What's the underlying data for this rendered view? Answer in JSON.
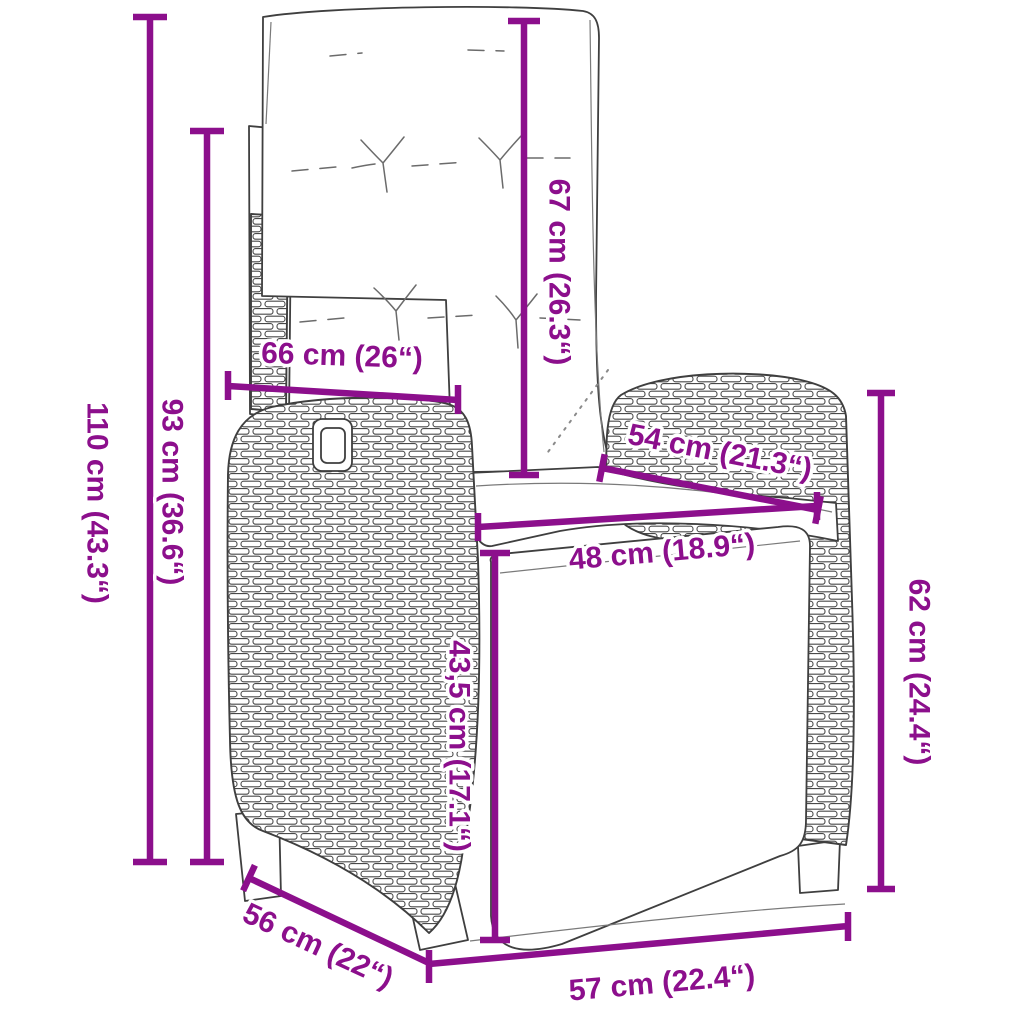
{
  "style": {
    "dimension_color": "#8C0F8C",
    "line_art_color": "#3f3f3f",
    "background": "#ffffff"
  },
  "dimensions": {
    "overall_height": {
      "label": "110 cm (43.3“)",
      "cm": "110",
      "inches": "43.3"
    },
    "backrest_height": {
      "label": "93 cm (36.6“)",
      "cm": "93",
      "inches": "36.6"
    },
    "armrest_top_width": {
      "label": "66 cm (26“)",
      "cm": "66",
      "inches": "26"
    },
    "back_cushion_height": {
      "label": "67 cm (26.3“)",
      "cm": "67",
      "inches": "26.3"
    },
    "armrest_depth": {
      "label": "54 cm (21.3“)",
      "cm": "54",
      "inches": "21.3"
    },
    "seat_width": {
      "label": "48 cm (18.9“)",
      "cm": "48",
      "inches": "18.9"
    },
    "footrest_height": {
      "label": "43,5 cm (17.1“)",
      "cm": "43,5",
      "inches": "17.1"
    },
    "armrest_height": {
      "label": "62 cm (24.4“)",
      "cm": "62",
      "inches": "24.4"
    },
    "base_depth": {
      "label": "56 cm (22“)",
      "cm": "56",
      "inches": "22"
    },
    "base_width": {
      "label": "57 cm (22.4“)",
      "cm": "57",
      "inches": "22.4"
    }
  }
}
